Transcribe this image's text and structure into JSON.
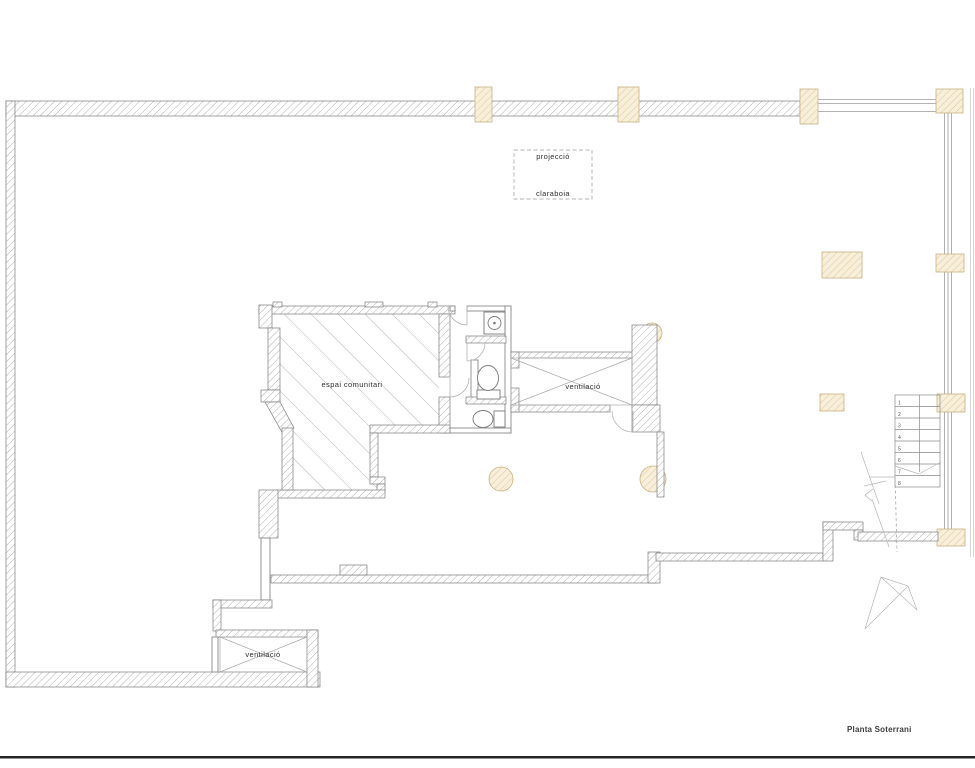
{
  "sheet": {
    "title": "Planta Soterrani"
  },
  "skylight_box": {
    "line1": "projecció",
    "line2": "claraboia"
  },
  "rooms": {
    "communal": {
      "label": "espai comunitari"
    },
    "vent_shaft_center": {
      "label": "ventilació"
    },
    "vent_shaft_bottom": {
      "label": "ventilació"
    }
  },
  "stairs": {
    "steps": [
      "1",
      "2",
      "3",
      "4",
      "5",
      "6",
      "7",
      "8"
    ]
  },
  "colors": {
    "wall_hatch": "#9c9c9c",
    "wall_outline": "#7c7c7c",
    "column_fill": "#f7efd9",
    "column_hatch": "#d9c48f",
    "room_hatch": "#c9c9c9",
    "label_text": "#2e2e2e",
    "sheet_border": "#242424"
  }
}
